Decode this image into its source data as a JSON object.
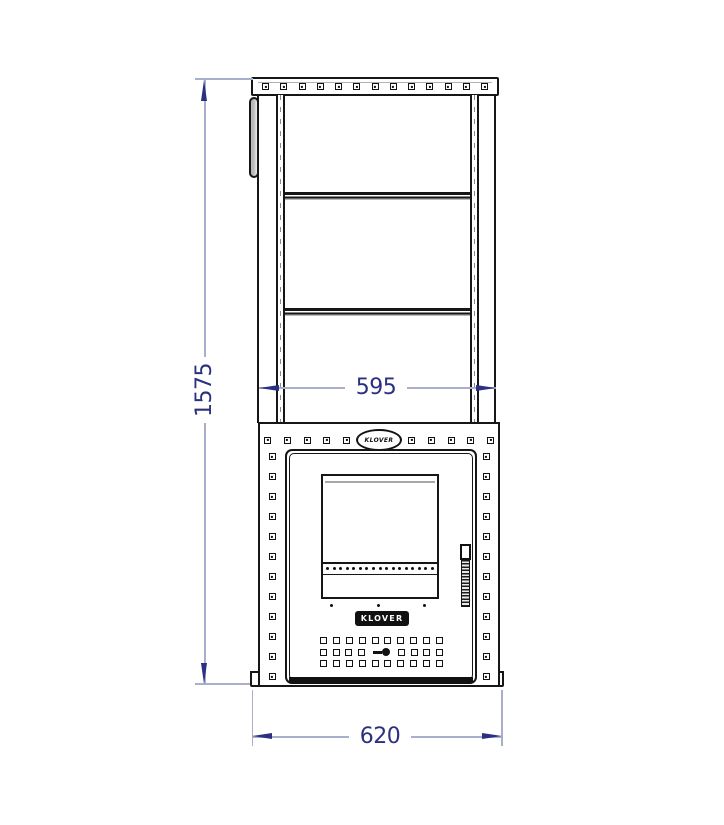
{
  "drawing": {
    "type": "stove-front-view-technical-drawing",
    "brand_plate": "KLOVER",
    "oval_logo": "KLOVER",
    "dimensions": {
      "overall_height": "1575",
      "stone_cage_width": "595",
      "base_width": "620"
    },
    "colors": {
      "line": "#161616",
      "dimension_line": "#a9aecd",
      "dimension_accent": "#2b3080",
      "metal_gray": "#c9c9c9"
    },
    "counts": {
      "cap_rivets": 13,
      "panel_top_rivets_left": 5,
      "panel_top_rivets_right": 5,
      "panel_side_rivets": 12,
      "vent_cols": 10,
      "vent_half_row": 4,
      "window_vent_dots": 17,
      "under_window_dots": 3
    }
  }
}
